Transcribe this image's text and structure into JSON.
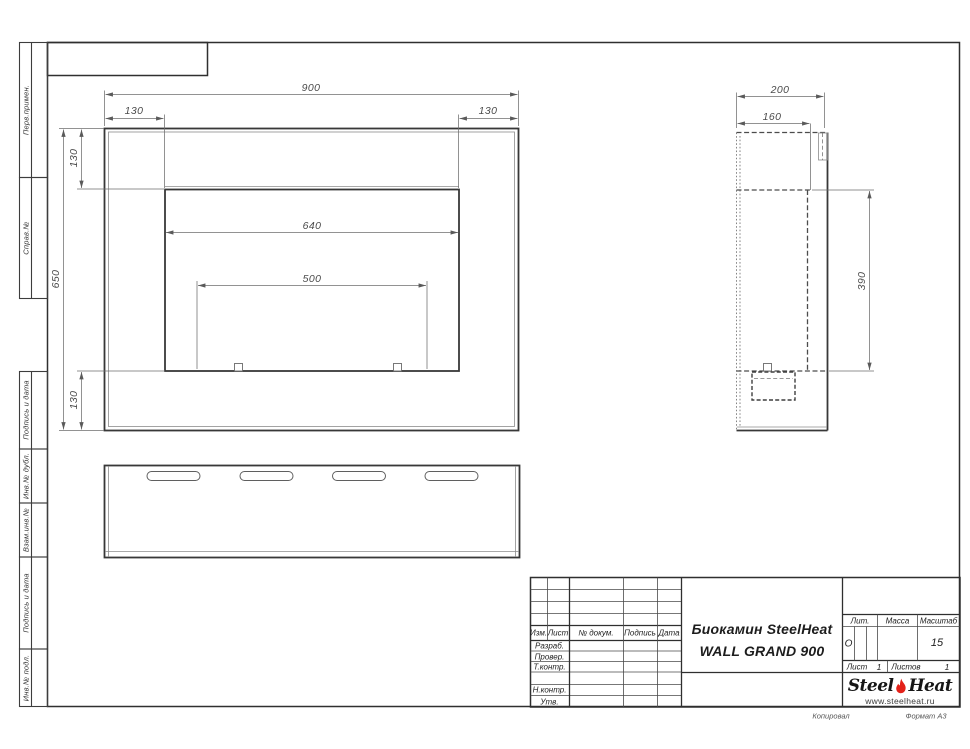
{
  "margin_labels": {
    "perv_primen": "Перв.примен.",
    "sprav_no": "Справ.№",
    "podpis_data_1": "Подпись и дата",
    "inv_dubl": "Инв.№ дубл.",
    "vzam_inv": "Взам.инв.№",
    "podpis_data_2": "Подпись и дата",
    "inv_podl": "Инв.№ подл."
  },
  "dims": {
    "front_width": "900",
    "front_flange_left": "130",
    "front_flange_right": "130",
    "front_flange_top": "130",
    "front_flange_bottom": "130",
    "front_height": "650",
    "opening_width": "640",
    "burner_width": "500",
    "side_depth": "200",
    "side_inner_depth": "160",
    "side_inner_height": "390"
  },
  "title_block": {
    "col_izm": "Изм.",
    "col_list": "Лист",
    "col_doc": "№ докум.",
    "col_sign": "Подпись",
    "col_date": "Дата",
    "row_razrab": "Разраб.",
    "row_prover": "Провер.",
    "row_tkontr": "Т.контр.",
    "row_nkontr": "Н.контр.",
    "row_utv": "Утв.",
    "product_line1": "Биокамин SteelHeat",
    "product_line2": "WALL GRAND 900",
    "lit_label": "Лит.",
    "lit_value": "О",
    "mass_label": "Масса",
    "scale_label": "Масштаб",
    "scale_value": "15",
    "sheet_label": "Лист",
    "sheet_value": "1",
    "sheets_label": "Листов",
    "sheets_value": "1"
  },
  "logo": {
    "part1": "Steel",
    "part2": "Heat",
    "url": "www.steelheat.ru"
  },
  "footer": {
    "copied": "Копировал",
    "format": "Формат А3"
  },
  "colors": {
    "flame_red": "#e32119",
    "line_dark": "#3f3f3f",
    "line_gray": "#707070"
  }
}
